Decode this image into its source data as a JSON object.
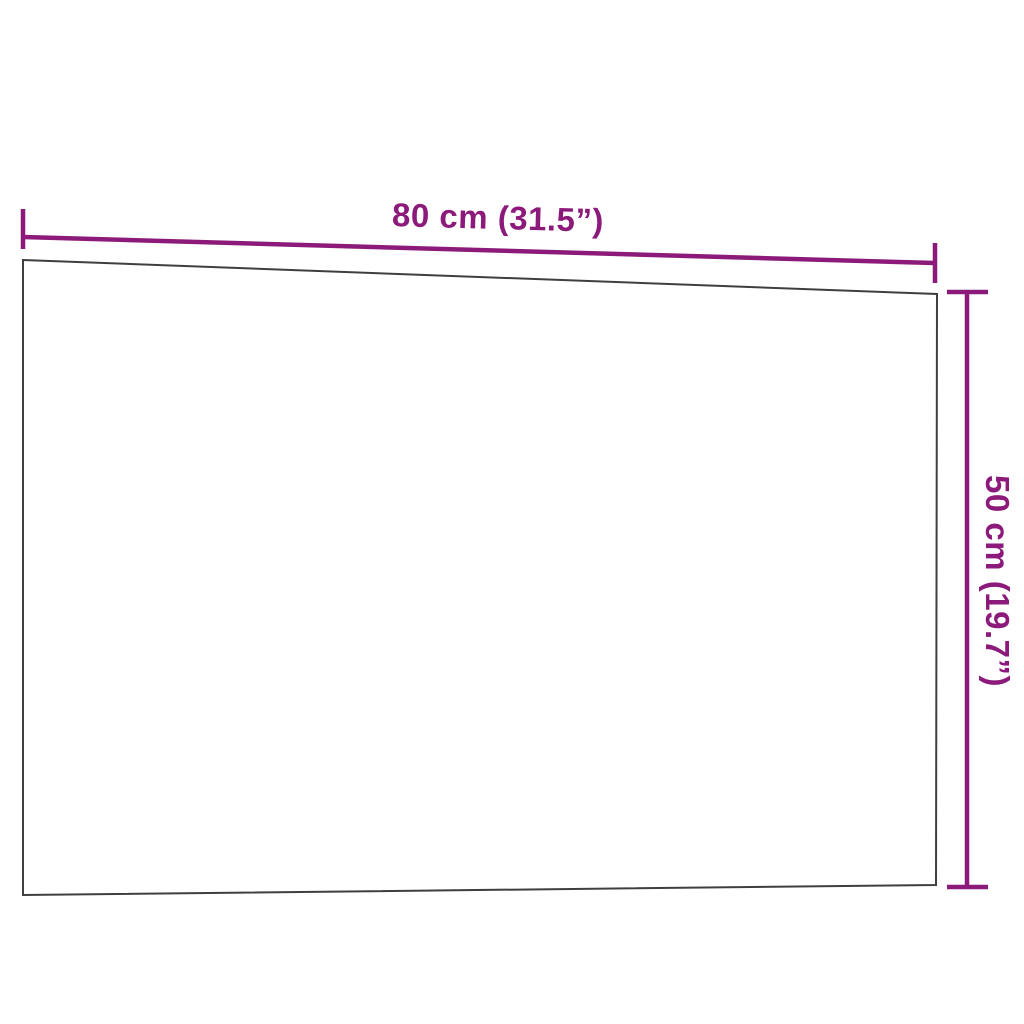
{
  "diagram": {
    "type": "product-dimension-diagram",
    "product_shape": "wall-mounted rectangular board (slight perspective view)",
    "dimensions": {
      "width": {
        "label": "80 cm (31.5”)",
        "cm": 80,
        "inches": 31.5
      },
      "height": {
        "label": "50 cm (19.7”)",
        "cm": 50,
        "inches": 19.7
      }
    },
    "colors": {
      "dimension_color": "#8C1A7B",
      "outline_color": "#3F3F3F",
      "board_fill": "#FFFFFF",
      "background": "#FFFFFF"
    }
  }
}
